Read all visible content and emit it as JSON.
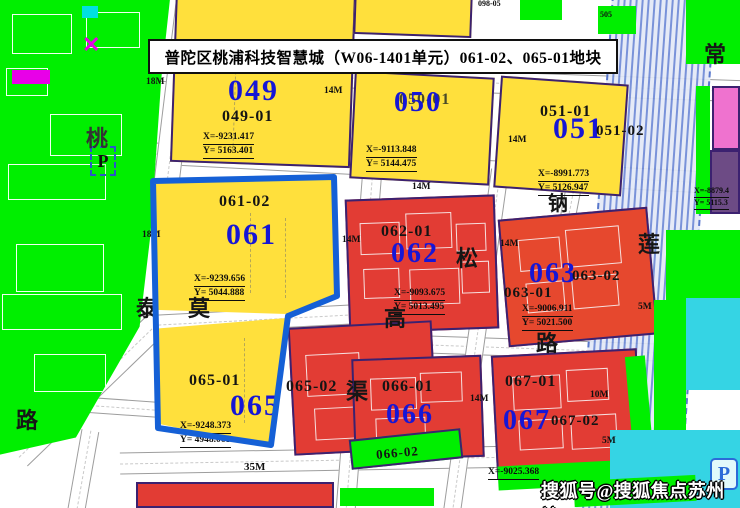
{
  "banner": {
    "title": "普陀区桃浦科技智慧城（W06-1401单元）061-02、065-01地块"
  },
  "watermark": {
    "text": "搜狐号@搜狐焦点苏州站"
  },
  "parcels": {
    "p049": {
      "code": "049",
      "sub": "049-01",
      "coord_x": "X=-9231.417",
      "coord_y": "Y= 5163.401"
    },
    "p050": {
      "code": "050",
      "sub": "050-01",
      "coord_x": "X=-9113.848",
      "coord_y": "Y= 5144.475"
    },
    "p051": {
      "code": "051",
      "sub": "051-01",
      "sub2": "051-02",
      "coord_x": "X=-8991.773",
      "coord_y": "Y= 5126.947"
    },
    "p061": {
      "code": "061",
      "sub": "061-02",
      "coord_x": "X=-9239.656",
      "coord_y": "Y= 5044.888"
    },
    "p062": {
      "code": "062",
      "sub": "062-01",
      "coord_x": "X=-9093.675",
      "coord_y": "Y= 5013.495"
    },
    "p063": {
      "code": "063",
      "sub": "063-01",
      "sub2": "063-02",
      "coord_x": "X=-9006.911",
      "coord_y": "Y= 5021.500"
    },
    "p065": {
      "code": "065",
      "sub": "065-01",
      "coord_x": "X=-9248.373",
      "coord_y": "Y= 4948.068"
    },
    "p065_02": {
      "sub": "065-02"
    },
    "p066": {
      "code": "066",
      "sub": "066-01",
      "sub2": "066-02"
    },
    "p067": {
      "code": "067",
      "sub": "067-01",
      "sub2": "067-02",
      "coord_x": "X=-9025.368"
    },
    "p_right": {
      "coord_x": "X=-8879.4",
      "coord_y": "Y= 5115.3"
    }
  },
  "road_labels": {
    "tao": "桃",
    "tai": "泰",
    "lu_left": "路",
    "mo": "莫",
    "gao": "高",
    "qu": "渠",
    "song": "松",
    "lu_mid": "路",
    "na": "钠",
    "lian": "莲",
    "chang": "常"
  },
  "width_labels": {
    "w18_top": "18M",
    "w18_mid": "18M",
    "w14_a": "14M",
    "w14_b": "14M",
    "w14_c": "14M",
    "w14_d": "14M",
    "w14_e": "14M",
    "w14_f": "14M",
    "w10": "10M",
    "w5_a": "5M",
    "w5_b": "5M",
    "w35": "35M"
  },
  "tiny_labels": {
    "t1": "098-05",
    "t2": "505"
  },
  "icons": {
    "parking_label": "P"
  },
  "colors": {
    "green": "#00ef00",
    "yellow": "#ffe03c",
    "red": "#e23c34",
    "red2": "#e6482e",
    "highlight_blue": "#1560d6",
    "code_blue": "#1616d6",
    "cyan": "#35d4e4",
    "pink": "#ef72cf",
    "purple": "#6d4b85",
    "magenta": "#e800e8"
  }
}
